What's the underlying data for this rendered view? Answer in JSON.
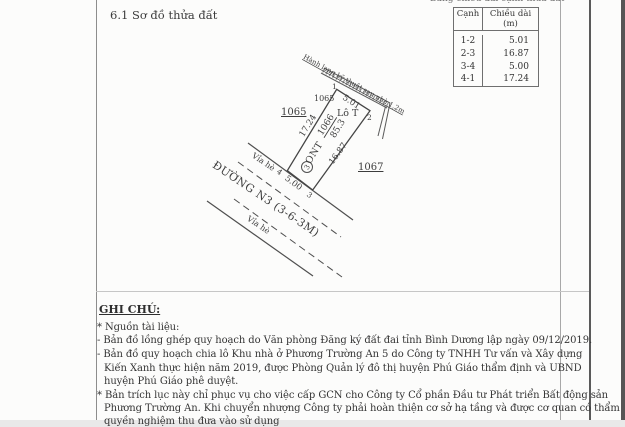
{
  "page": {
    "title": "6.1 Sơ đồ thửa đất",
    "table_caption": "Bảng chiều dài cạnh thửa đất"
  },
  "edge_table": {
    "headers": [
      "Cạnh",
      "Chiều dài (m)"
    ],
    "rows": [
      [
        "1-2",
        "5.01"
      ],
      [
        "2-3",
        "16.87"
      ],
      [
        "3-4",
        "5.00"
      ],
      [
        "4-1",
        "17.24"
      ]
    ]
  },
  "diagram": {
    "corridor_label": "Hành lang kỹ thuật sau nhà 1,2m",
    "lot_label": "Lô T",
    "land_use_code": "ONT",
    "parcel_number": "1066",
    "area": "85.3",
    "block_marker": "3",
    "dim_12": "5.01",
    "dim_23": "16.87",
    "dim_34": "5.00",
    "dim_41": "17.24",
    "vertex_1": "1",
    "vertex_2": "2",
    "vertex_3": "3",
    "vertex_4": "4",
    "neighbor_left": "1065",
    "neighbor_left_top": "1065",
    "neighbor_right": "1067",
    "road_name": "ĐƯỜNG N3 (3-6-3M)",
    "sidewalk_upper": "Vỉa hè",
    "sidewalk_lower": "Vỉa hè"
  },
  "notes": {
    "heading": "GHI CHÚ:",
    "lines": [
      "* Nguồn tài liệu:",
      "- Bản đồ lồng ghép quy hoạch do Văn phòng Đăng ký đất đai tỉnh Bình Dương lập ngày 09/12/2019.",
      "- Bản đồ quy hoạch chia lô Khu nhà ở Phương Trường An 5 do Công ty TNHH Tư vấn và Xây dựng",
      "Kiến Xanh thực hiện năm 2019, được Phòng Quản lý đô thị huyện Phú Giáo thẩm định và UBND",
      "huyện Phú Giáo phê duyệt.",
      "* Bản trích lục này chỉ phục vụ cho việc cấp GCN cho Công ty Cổ phần Đầu tư Phát triển Bất động sản",
      "Phương Trường An. Khi chuyển nhượng Công ty phải hoàn thiện cơ sở hạ tầng và được cơ quan có thẩm",
      "quyền nghiệm thu đưa vào sử dụng"
    ]
  }
}
